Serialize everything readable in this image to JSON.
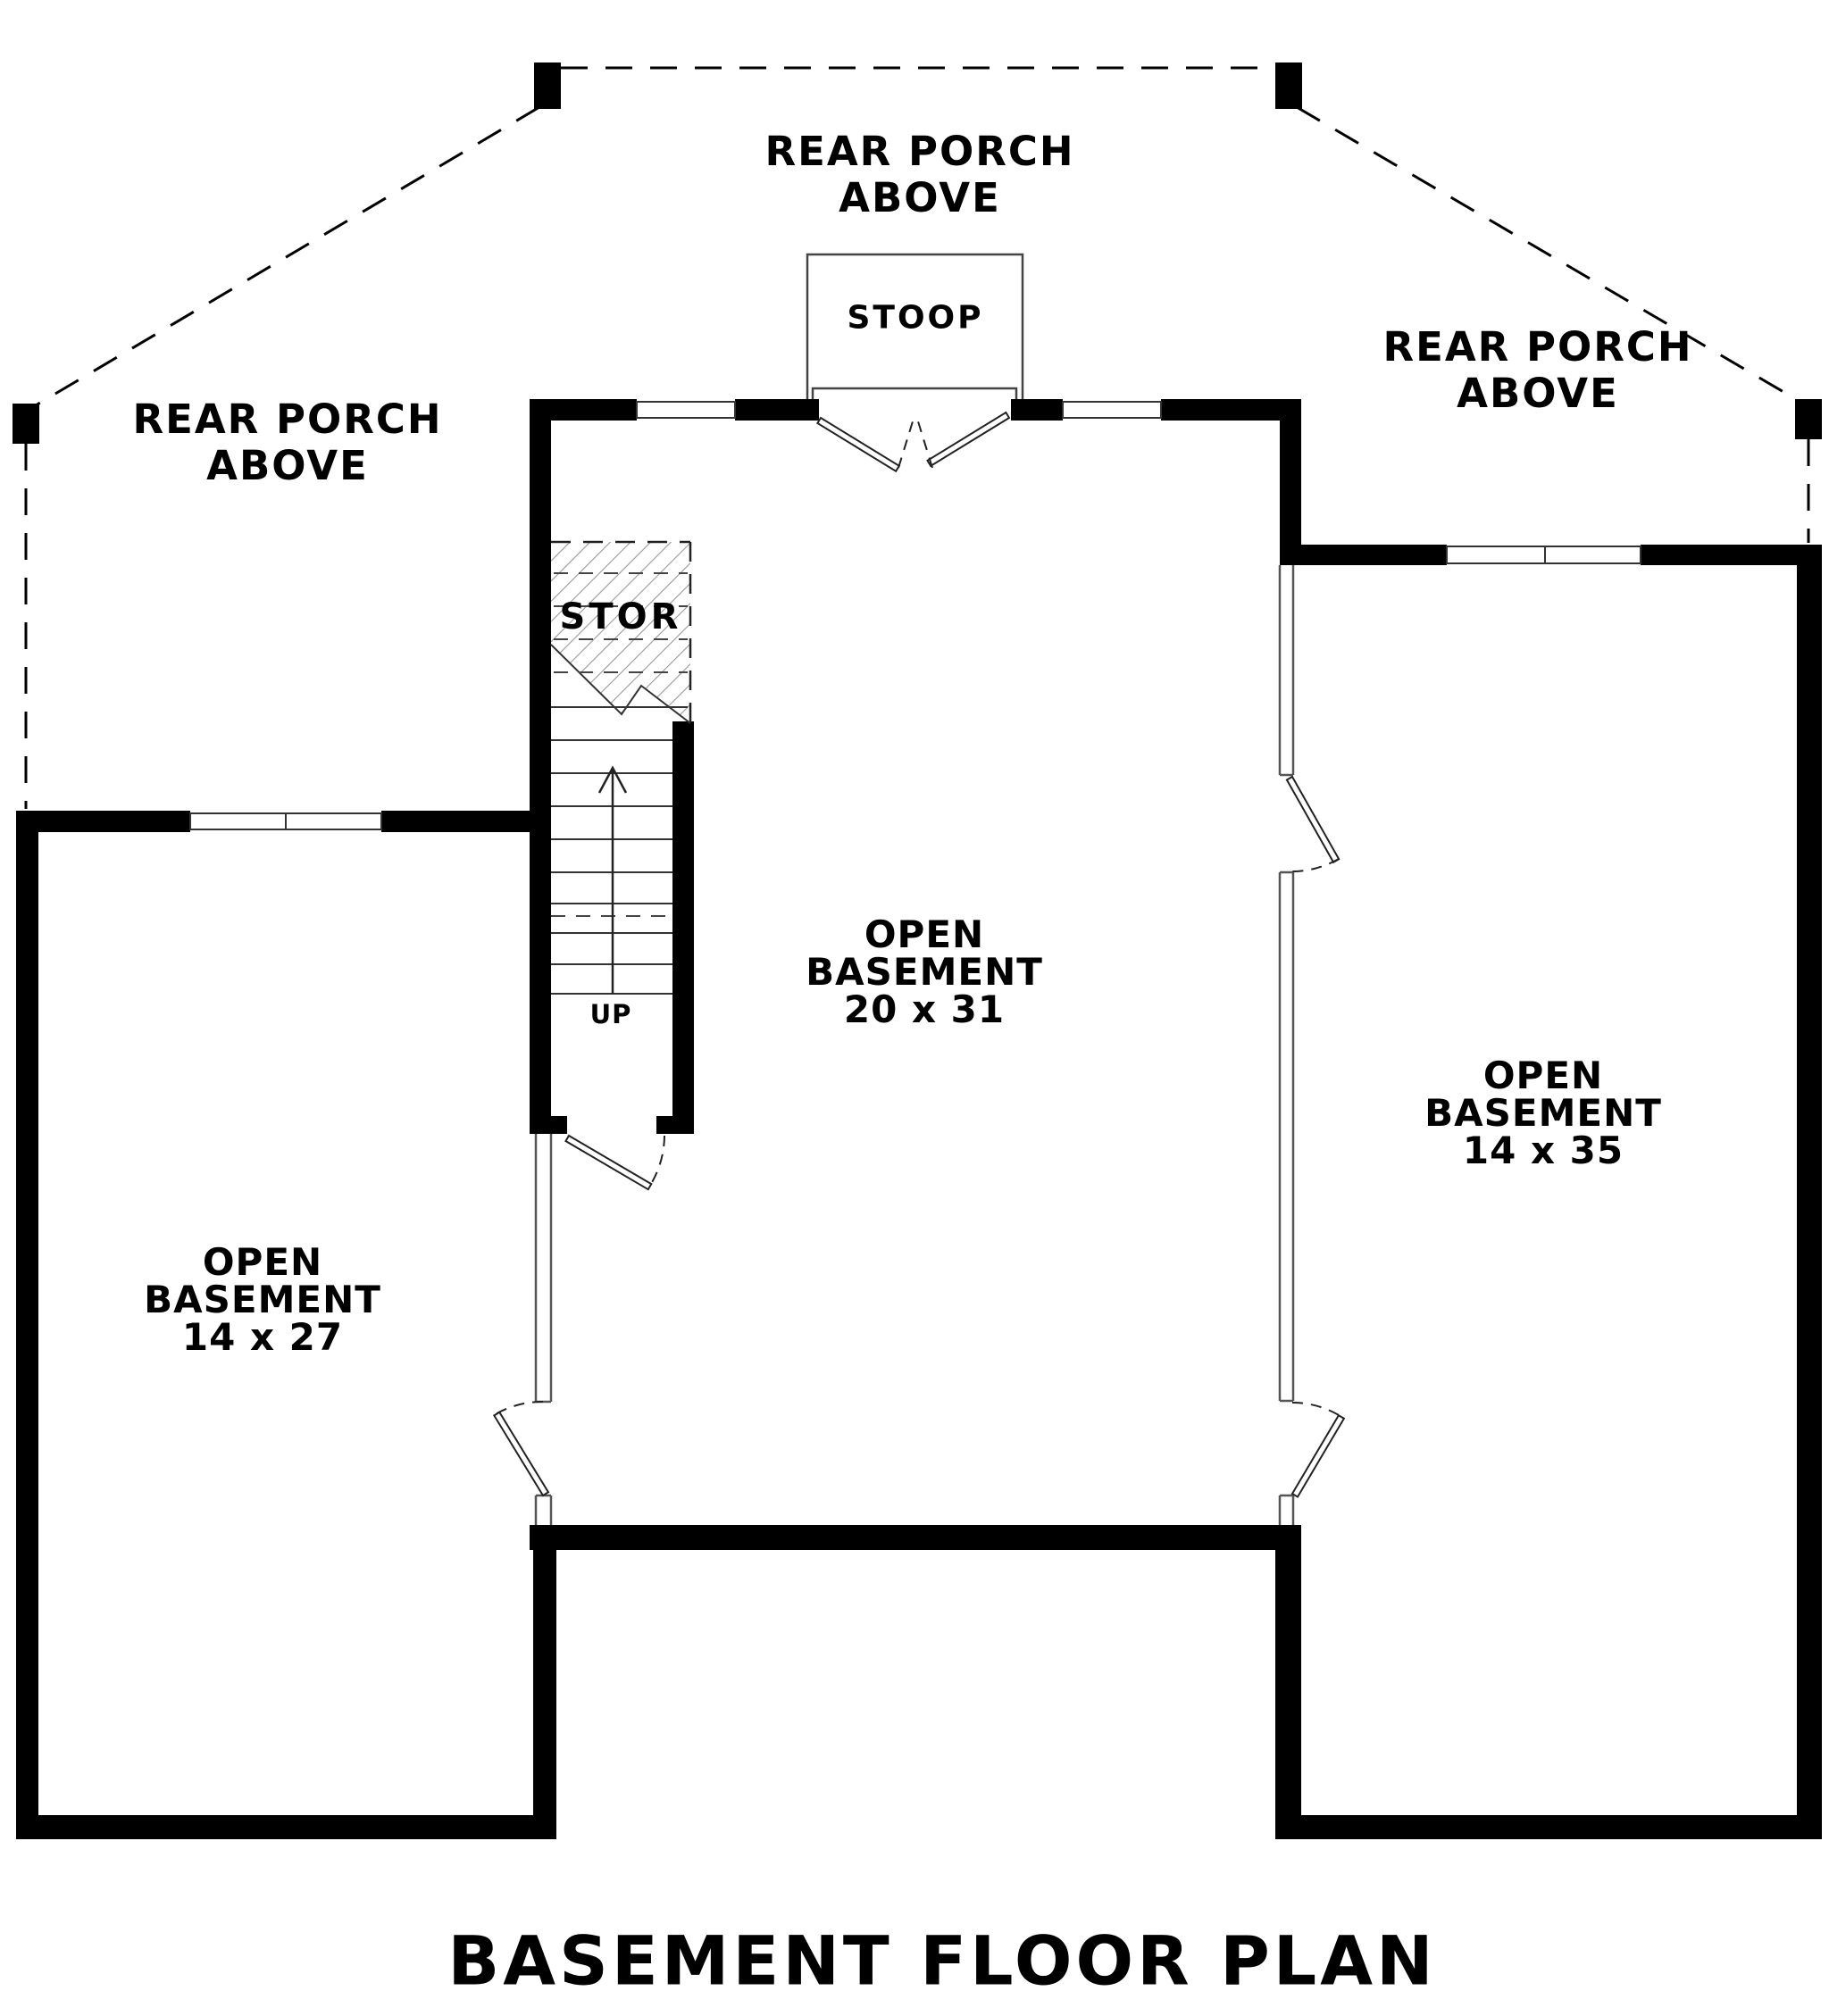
{
  "title": "BASEMENT FLOOR PLAN",
  "colors": {
    "background": "#ffffff",
    "ink": "#000000",
    "wall_fill": "#000000",
    "hatch": "#999999",
    "thin_wall": "#555555"
  },
  "labels": {
    "porches": [
      {
        "position": "top",
        "line1": "REAR PORCH",
        "line2": "ABOVE"
      },
      {
        "position": "left",
        "line1": "REAR PORCH",
        "line2": "ABOVE"
      },
      {
        "position": "right",
        "line1": "REAR PORCH",
        "line2": "ABOVE"
      }
    ],
    "stoop": "STOOP",
    "storage": "STOR",
    "stairs_direction": "UP"
  },
  "rooms": [
    {
      "position": "center",
      "name_line1": "OPEN",
      "name_line2": "BASEMENT",
      "dimensions": "20 x 31"
    },
    {
      "position": "right",
      "name_line1": "OPEN",
      "name_line2": "BASEMENT",
      "dimensions": "14 x 35"
    },
    {
      "position": "left",
      "name_line1": "OPEN",
      "name_line2": "BASEMENT",
      "dimensions": "14 x 27"
    }
  ]
}
